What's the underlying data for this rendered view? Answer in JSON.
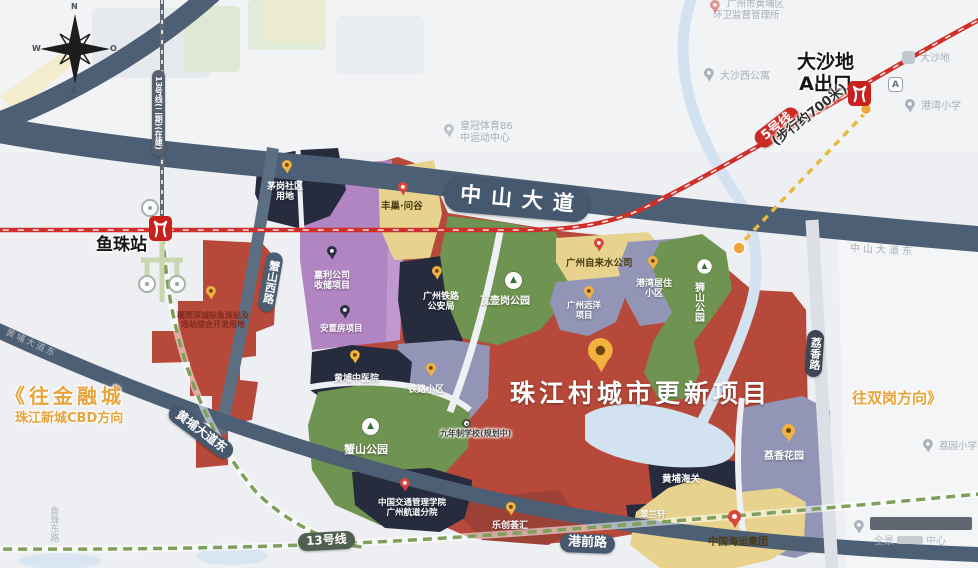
{
  "project": {
    "title": "珠江村城市更新项目"
  },
  "compass": {
    "n": "N",
    "w": "W",
    "e": "O",
    "s": "S"
  },
  "roads": {
    "zhongshan_avenue": "中山大道",
    "xieshan_west_road": "蟹山西路",
    "huangpu_avenue_east": "黄埔大道东",
    "gangqian_road": "港前路",
    "lixiang_road": "荔香路",
    "zhongshan_avenue_east_faint": "中山大道东",
    "huangpu_avenue_east_faint": "黄埔大道东",
    "yuzhu_east_road_faint": "鱼珠东路"
  },
  "transit": {
    "line5": "5号线",
    "line13": "13号线",
    "line13_phase2": "13号线(二期)(在建)",
    "walk_distance": "(步行约700米)",
    "yuzhu_station": "鱼珠站",
    "dashadi_station": "大沙地",
    "dashadi_exit": "A出口",
    "exit_a_badge": "A"
  },
  "directions": {
    "to_financial_city": "《往金融城",
    "to_zhujiang_cbd": "珠江新城CBD方向",
    "to_shuanggang": "往双岗方向》"
  },
  "parcels": {
    "suiwanshen_l1": "穗莞深城际鱼珠站及",
    "suiwanshen_l2": "场站综合开发用地",
    "maogang_l1": "茅岗社区",
    "maogang_l2": "用地",
    "jiali_l1": "嘉利公司",
    "jiali_l2": "收储项目",
    "anzhifang": "安置房项目",
    "fengchao": "丰巢·问谷",
    "railway_police_l1": "广州铁路",
    "railway_police_l2": "公安局",
    "wahugang_park": "瓦壶岗公园",
    "water_company": "广州自来水公司",
    "gangwan_estate_l1": "港湾居住",
    "gangwan_estate_l2": "小区",
    "yuanyang_l1": "广州远洋",
    "yuanyang_l2": "项目",
    "shishan_park": "狮山公园",
    "railway_estate": "铁路小区",
    "tcm_hospital": "黄埔中医院",
    "xieshan_park": "蟹山公园",
    "nine_year_school": "九年制学校(规划中)",
    "transport_college_l1": "中国交通管理学院",
    "transport_college_l2": "广州航道分院",
    "lechuang": "乐创荟汇",
    "lixiang_garden": "荔香花园",
    "huangpu_customs": "黄埔海关",
    "cuilanxuan": "翠兰轩",
    "china_shipping": "中国海运集团",
    "huangpu_port_station": "黄埔水运站"
  },
  "pois": {
    "sanitation_l1": "广州市黄埔区",
    "sanitation_l2": "环卫监督管理所",
    "dashaxi_apartment": "大沙西公寓",
    "dashadi_area": "大沙地",
    "gangwan_school": "港湾小学",
    "liyuan_school": "荔园小学",
    "sports_l1": "皇冠体育86",
    "sports_l2": "中运动中心",
    "watermark_l1": "全景",
    "watermark_l2": "中心"
  },
  "colors": {
    "parcel_red": "#b7493a",
    "parcel_navy": "#262b3d",
    "parcel_purple": "#b184c2",
    "parcel_gray": "#9295b5",
    "parcel_yellow": "#e7d38e",
    "park_green": "#6f9350",
    "road_dark": "#4d5f75",
    "line5_red": "#cf2f28",
    "line13_green": "#7fa05a",
    "walk_yellow": "#e9b83e",
    "direction_orange": "#e8a33c",
    "water_blue": "#d3e2f0"
  }
}
